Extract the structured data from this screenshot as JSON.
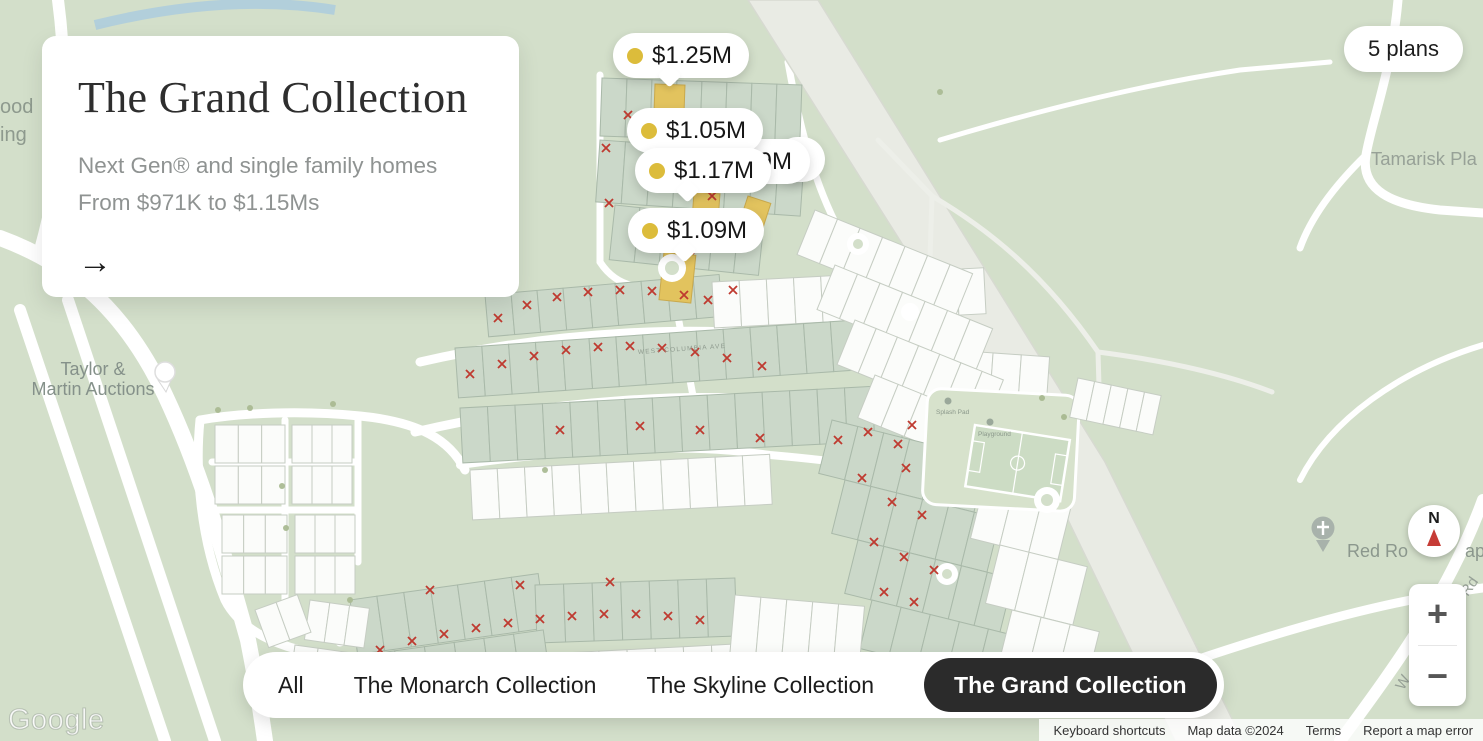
{
  "colors": {
    "map_background": "#d3dfca",
    "marker_dot": "#dcbc3b",
    "selected_tab_bg": "#2b2b2b",
    "available_lot_yellow": "#e2c35e",
    "sold_x_red": "#bf3a30"
  },
  "info_card": {
    "title": "The Grand Collection",
    "line1": "Next Gen® and single family homes",
    "line2": "From $971K to $1.15Ms",
    "arrow": "→"
  },
  "plans_button": {
    "label": "5 plans"
  },
  "markers": {
    "m1": "$1.25M",
    "m2": "$1.05M",
    "m3": "$1.17M",
    "m4": "$1.09M",
    "frag_9m": "9M",
    "frag_1": "1"
  },
  "filter_bar": {
    "tabs": [
      {
        "label": "All",
        "selected": false
      },
      {
        "label": "The Monarch Collection",
        "selected": false
      },
      {
        "label": "The Skyline Collection",
        "selected": false
      },
      {
        "label": "The Grand Collection",
        "selected": true
      }
    ]
  },
  "map_labels": {
    "frag_top_left_1": "ood",
    "frag_top_left_2": "ing",
    "tamarisk": "Tamarisk Pla",
    "taylor_line1": "Taylor &",
    "taylor_line2": "Martin Auctions",
    "red_rock": "Red Ro",
    "red_rock_frag": "ap",
    "road_frag_rd": "Rd",
    "road_frag_w": "W",
    "street_columbia": "WEST COLUMBIA AVE",
    "poi_splash_pad": "Splash Pad",
    "poi_playground": "Playground"
  },
  "controls": {
    "compass_n": "N",
    "zoom_in": "+",
    "zoom_out": "−",
    "google": "Google"
  },
  "attribution": [
    "Keyboard shortcuts",
    "Map data ©2024",
    "Terms",
    "Report a map error"
  ]
}
